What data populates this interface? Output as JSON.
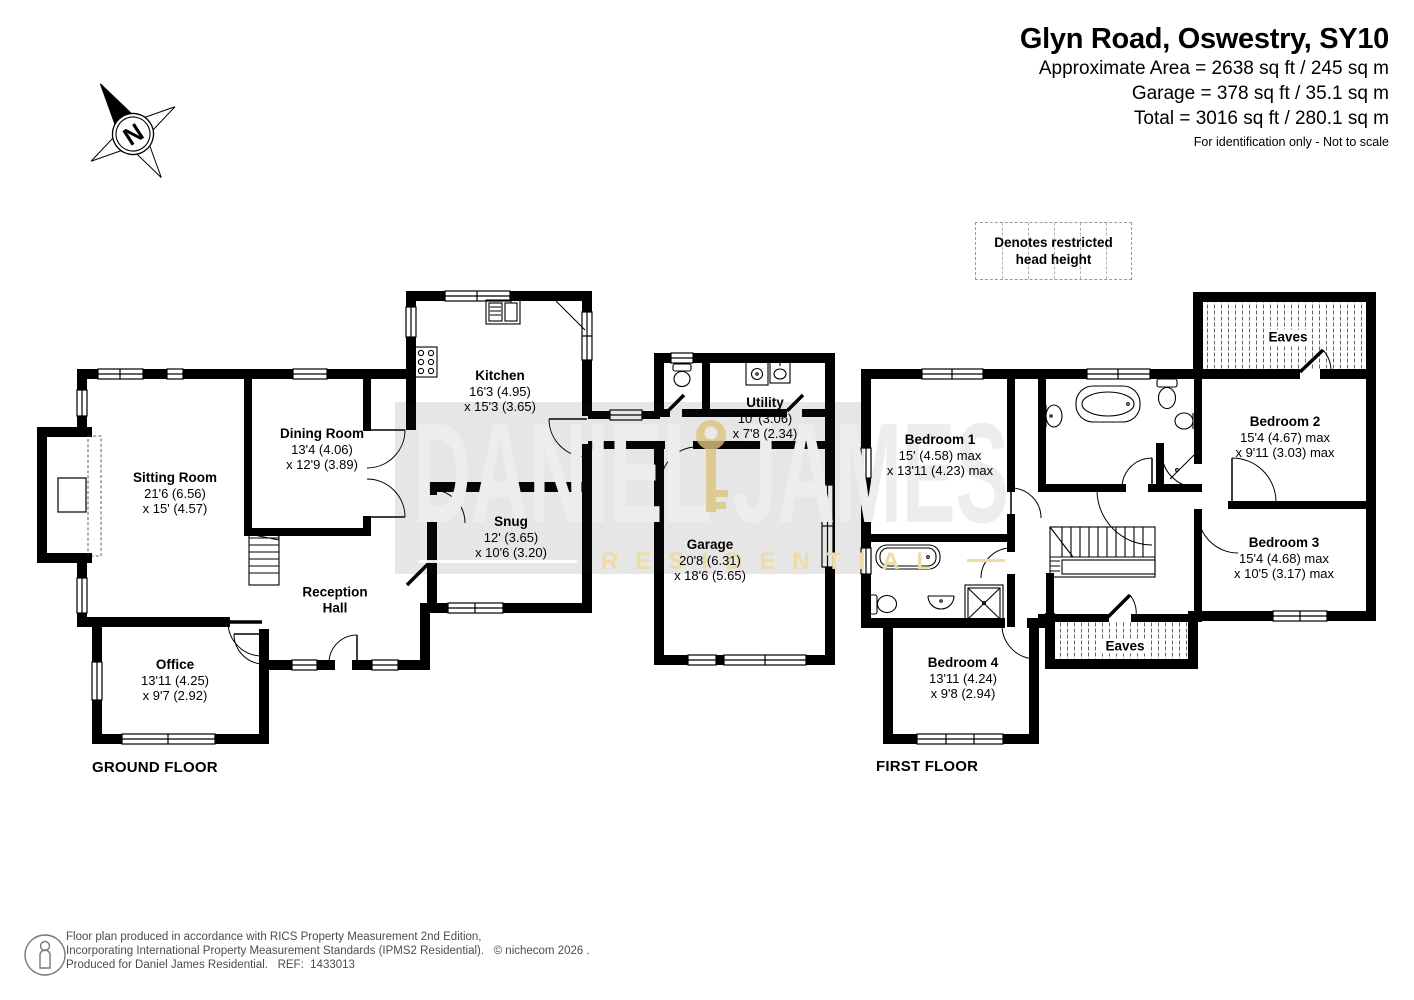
{
  "header": {
    "title": "Glyn Road, Oswestry, SY10",
    "area_line": "Approximate Area = 2638 sq ft / 245 sq m",
    "garage_line": "Garage = 378 sq ft / 35.1 sq m",
    "total_line": "Total = 3016 sq ft / 280.1 sq m",
    "disclaimer": "For identification only - Not to scale"
  },
  "compass": {
    "letter": "N"
  },
  "legend": {
    "text": "Denotes restricted head height"
  },
  "watermark": {
    "brand": "DANIEL JAMES",
    "brand_sub": "RESIDENTIAL"
  },
  "ground_floor": {
    "label": "GROUND FLOOR",
    "rooms": {
      "sitting": {
        "name": "Sitting Room",
        "dim1": "21'6 (6.56)",
        "dim2": "x 15' (4.57)"
      },
      "dining": {
        "name": "Dining Room",
        "dim1": "13'4 (4.06)",
        "dim2": "x 12'9 (3.89)"
      },
      "kitchen": {
        "name": "Kitchen",
        "dim1": "16'3 (4.95)",
        "dim2": "x 15'3 (3.65)"
      },
      "utility": {
        "name": "Utility",
        "dim1": "10' (3.06)",
        "dim2": "x 7'8 (2.34)"
      },
      "snug": {
        "name": "Snug",
        "dim1": "12' (3.65)",
        "dim2": "x 10'6 (3.20)"
      },
      "garage": {
        "name": "Garage",
        "dim1": "20'8 (6.31)",
        "dim2": "x 18'6 (5.65)"
      },
      "office": {
        "name": "Office",
        "dim1": "13'11 (4.25)",
        "dim2": "x 9'7 (2.92)"
      },
      "reception": {
        "name": "Reception",
        "name2": "Hall"
      }
    }
  },
  "first_floor": {
    "label": "FIRST FLOOR",
    "eaves_label": "Eaves",
    "rooms": {
      "bed1": {
        "name": "Bedroom 1",
        "dim1": "15' (4.58) max",
        "dim2": "x 13'11 (4.23) max"
      },
      "bed2": {
        "name": "Bedroom 2",
        "dim1": "15'4 (4.67) max",
        "dim2": "x 9'11 (3.03) max"
      },
      "bed3": {
        "name": "Bedroom 3",
        "dim1": "15'4 (4.68) max",
        "dim2": "x 10'5 (3.17) max"
      },
      "bed4": {
        "name": "Bedroom 4",
        "dim1": "13'11 (4.24)",
        "dim2": "x 9'8 (2.94)"
      }
    }
  },
  "footer": {
    "line1": "Floor plan produced in accordance with RICS Property Measurement 2nd Edition,",
    "line2": "Incorporating International Property Measurement Standards (IPMS2 Residential).   © nichecom 2026 .",
    "line3": "Produced for Daniel James Residential.   REF:  1433013"
  }
}
